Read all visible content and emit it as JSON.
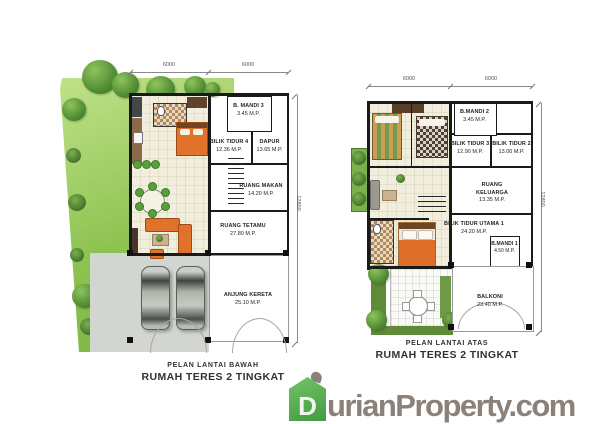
{
  "plans": {
    "ground": {
      "caption_line1": "PELAN LANTAI BAWAH",
      "caption_line2": "RUMAH TERES 2 TINGKAT",
      "dim_top_left": "6000",
      "dim_top_right": "6000",
      "dim_side": "12800",
      "rooms": [
        {
          "name": "B. MANDI 3",
          "area": "3.45 M.P."
        },
        {
          "name": "BILIK TIDUR 4",
          "area": "12.36 M.P."
        },
        {
          "name": "DAPUR",
          "area": "13.65 M.P."
        },
        {
          "name": "RUANG MAKAN",
          "area": "14.20 M.P."
        },
        {
          "name": "RUANG TETAMU",
          "area": "27.80 M.P."
        },
        {
          "name": "ANJUNG KERETA",
          "area": "25.10 M.P."
        }
      ]
    },
    "upper": {
      "caption_line1": "PELAN LANTAI ATAS",
      "caption_line2": "RUMAH TERES 2 TINGKAT",
      "dim_top_left": "6000",
      "dim_top_right": "6000",
      "dim_side": "12800",
      "rooms": [
        {
          "name": "B.MANDI 2",
          "area": "3.45 M.P."
        },
        {
          "name": "BILIK TIDUR 3",
          "area": "12.90 M.P."
        },
        {
          "name": "BILIK TIDUR 2",
          "area": "13.00 M.P."
        },
        {
          "name": "RUANG KELUARGA",
          "area": "13.35 M.P."
        },
        {
          "name": "BILIK TIDUR UTAMA 1",
          "area": "24.20 M.P."
        },
        {
          "name": "B.MANDI 1",
          "area": "4.50 M.P."
        },
        {
          "name": "BALKONI",
          "area": "23.40 M.P."
        }
      ]
    }
  },
  "watermark": {
    "letter_d": "D",
    "part1": "urian",
    "letter_p": "P",
    "part2": "roperty.com"
  },
  "colors": {
    "brand_green": "#5caf54",
    "brand_gray": "#8b8179",
    "lawn_green": "#8ec352",
    "furniture_orange": "#e0712a"
  }
}
